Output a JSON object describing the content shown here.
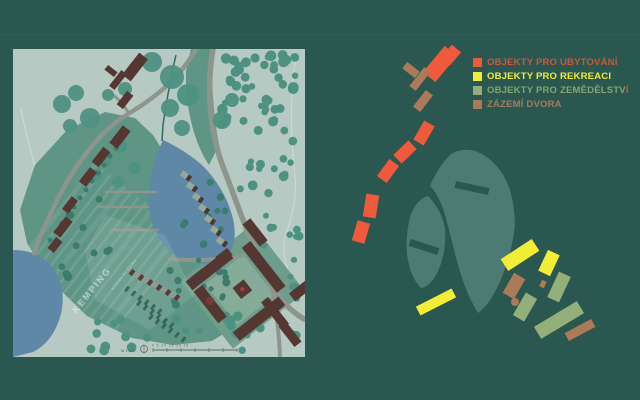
{
  "slide": {
    "background": "#2b5751"
  },
  "colors": {
    "bg": "#2b5751",
    "paper": "#b7c9c3",
    "water": "#5f88a6",
    "green": "#5f9585",
    "green_stripe": "#7bab9b",
    "road": "#8d968c",
    "building": "#553732",
    "tree": "#4d9181",
    "tree_dark": "#3c7c6d",
    "fan": "#4d7a73",
    "orange": "#ee5a3b",
    "yellow": "#f2ee35",
    "lgreen": "#93b07b",
    "brown": "#ab7a58",
    "red_dot": "#7a3b35"
  },
  "legend": {
    "items": [
      {
        "label": "OBJEKTY PRO UBYTOVÁNÍ",
        "suffix": "",
        "swatch": "#e85b3c",
        "text_color": "#cf5639",
        "suffix_color": "#cf5639"
      },
      {
        "label": "OBJEKTY PRO REKREACI",
        "suffix": "",
        "swatch": "#f0ec38",
        "text_color": "#f0ec38",
        "suffix_color": "#f0ec38"
      },
      {
        "label": "OBJEKTY PRO ZEMĚDĚLSTV",
        "suffix": "Í",
        "swatch": "#93ae7d",
        "text_color": "#84a470",
        "suffix_color": "#cf5639"
      },
      {
        "label": "ZÁZEMÍ DVORA",
        "suffix": "",
        "swatch": "#aa7a58",
        "text_color": "#a87b5c",
        "suffix_color": "#a87b5c"
      }
    ]
  },
  "map": {
    "kemping_label": "KEMPING",
    "pond_label": "VODNÍ PLOCHA",
    "scale_label": "M 1:500",
    "scale_ticks": "0    5    10    15    20    25",
    "tree_clusters": [
      {
        "x": 208,
        "y": 4,
        "w": 78,
        "h": 84,
        "n": 46,
        "rmin": 3,
        "rmax": 5.5,
        "c": "tree"
      },
      {
        "x": 222,
        "y": 92,
        "w": 60,
        "h": 64,
        "n": 13,
        "rmin": 3,
        "rmax": 5,
        "c": "tree"
      },
      {
        "x": 236,
        "y": 160,
        "w": 52,
        "h": 40,
        "n": 8,
        "rmin": 3,
        "rmax": 4.5,
        "c": "tree"
      },
      {
        "x": 77,
        "y": 268,
        "w": 110,
        "h": 34,
        "n": 14,
        "rmin": 3,
        "rmax": 5,
        "c": "tree"
      },
      {
        "x": 210,
        "y": 266,
        "w": 76,
        "h": 36,
        "n": 12,
        "rmin": 3,
        "rmax": 5,
        "c": "tree"
      },
      {
        "x": 272,
        "y": 205,
        "w": 16,
        "h": 55,
        "n": 5,
        "rmin": 3,
        "rmax": 4,
        "c": "tree"
      },
      {
        "x": 156,
        "y": 208,
        "w": 60,
        "h": 48,
        "n": 16,
        "rmin": 2.5,
        "rmax": 4,
        "c": "tree_dark"
      },
      {
        "x": 38,
        "y": 140,
        "w": 62,
        "h": 98,
        "n": 10,
        "rmin": 2.5,
        "rmax": 4.5,
        "c": "tree_dark"
      },
      {
        "x": 168,
        "y": 120,
        "w": 46,
        "h": 80,
        "n": 10,
        "rmin": 2.5,
        "rmax": 4,
        "c": "tree_dark"
      }
    ],
    "tree_blobs": [
      [
        49,
        55,
        9
      ],
      [
        63,
        44,
        8
      ],
      [
        77,
        69,
        10
      ],
      [
        57,
        77,
        7
      ],
      [
        95,
        46,
        6
      ],
      [
        112,
        40,
        7
      ],
      [
        139,
        13,
        10
      ],
      [
        159,
        28,
        12
      ],
      [
        175,
        46,
        11
      ],
      [
        157,
        59,
        9
      ],
      [
        169,
        79,
        8
      ],
      [
        107,
        97,
        7
      ],
      [
        92,
        111,
        7
      ],
      [
        83,
        126,
        6
      ],
      [
        105,
        133,
        6
      ],
      [
        122,
        119,
        6
      ],
      [
        209,
        71,
        9
      ],
      [
        219,
        51,
        7
      ]
    ],
    "road_dots": [
      [
        37,
        191
      ],
      [
        43,
        183
      ],
      [
        49,
        174
      ],
      [
        55,
        166
      ],
      [
        61,
        158
      ],
      [
        67,
        149
      ],
      [
        73,
        141
      ],
      [
        79,
        132
      ],
      [
        85,
        124
      ],
      [
        91,
        116
      ],
      [
        97,
        107
      ],
      [
        103,
        99
      ]
    ],
    "pitch_rows": [
      {
        "x0": 114,
        "y0": 240,
        "n": 6,
        "dx": 6.5,
        "dy": 4.5
      },
      {
        "x0": 126,
        "y0": 254,
        "n": 6,
        "dx": 6.5,
        "dy": 4.5
      },
      {
        "x0": 138,
        "y0": 268,
        "n": 6,
        "dx": 6.5,
        "dy": 4.5
      }
    ],
    "cabin_row2": {
      "x0": 117,
      "y0": 222,
      "n": 6,
      "dx": 9,
      "dy": 5
    }
  },
  "diagram": {
    "objects": [
      {
        "c": "orange",
        "cx": 440,
        "cy": 64,
        "w": 16,
        "h": 34,
        "rot": 40
      },
      {
        "c": "orange",
        "cx": 451,
        "cy": 55,
        "w": 12,
        "h": 17,
        "rot": 40
      },
      {
        "c": "orange",
        "cx": 424,
        "cy": 133,
        "w": 12,
        "h": 22,
        "rot": 30
      },
      {
        "c": "orange",
        "cx": 405,
        "cy": 152,
        "w": 12,
        "h": 21,
        "rot": 46
      },
      {
        "c": "orange",
        "cx": 388,
        "cy": 171,
        "w": 12,
        "h": 21,
        "rot": 36
      },
      {
        "c": "orange",
        "cx": 371,
        "cy": 206,
        "w": 13,
        "h": 23,
        "rot": 9
      },
      {
        "c": "orange",
        "cx": 361,
        "cy": 232,
        "w": 13,
        "h": 21,
        "rot": 16
      },
      {
        "c": "brown",
        "cx": 420,
        "cy": 79,
        "w": 8,
        "h": 24,
        "rot": 38
      },
      {
        "c": "brown",
        "cx": 411,
        "cy": 70,
        "w": 16,
        "h": 8,
        "rot": 38
      },
      {
        "c": "brown",
        "cx": 423,
        "cy": 101,
        "w": 9,
        "h": 21,
        "rot": 38
      },
      {
        "c": "yellow",
        "cx": 520,
        "cy": 255,
        "w": 37,
        "h": 14,
        "rot": -33
      },
      {
        "c": "yellow",
        "cx": 436,
        "cy": 302,
        "w": 40,
        "h": 10,
        "rot": -27
      },
      {
        "c": "yellow",
        "cx": 549,
        "cy": 263,
        "w": 13,
        "h": 23,
        "rot": 25
      },
      {
        "c": "lgreen",
        "cx": 559,
        "cy": 287,
        "w": 13,
        "h": 28,
        "rot": 25
      },
      {
        "c": "brown",
        "cx": 514,
        "cy": 286,
        "w": 13,
        "h": 23,
        "rot": 30
      },
      {
        "c": "lgreen",
        "cx": 525,
        "cy": 307,
        "w": 13,
        "h": 26,
        "rot": 30
      },
      {
        "c": "brown",
        "cx": 543,
        "cy": 284,
        "w": 5,
        "h": 7,
        "rot": 25
      },
      {
        "c": "lgreen",
        "cx": 559,
        "cy": 320,
        "w": 50,
        "h": 14,
        "rot": -31
      },
      {
        "c": "brown",
        "cx": 580,
        "cy": 330,
        "w": 30,
        "h": 9,
        "rot": -28
      }
    ],
    "dots": [
      {
        "c": "brown",
        "cx": 515,
        "cy": 302,
        "r": 4
      }
    ]
  }
}
